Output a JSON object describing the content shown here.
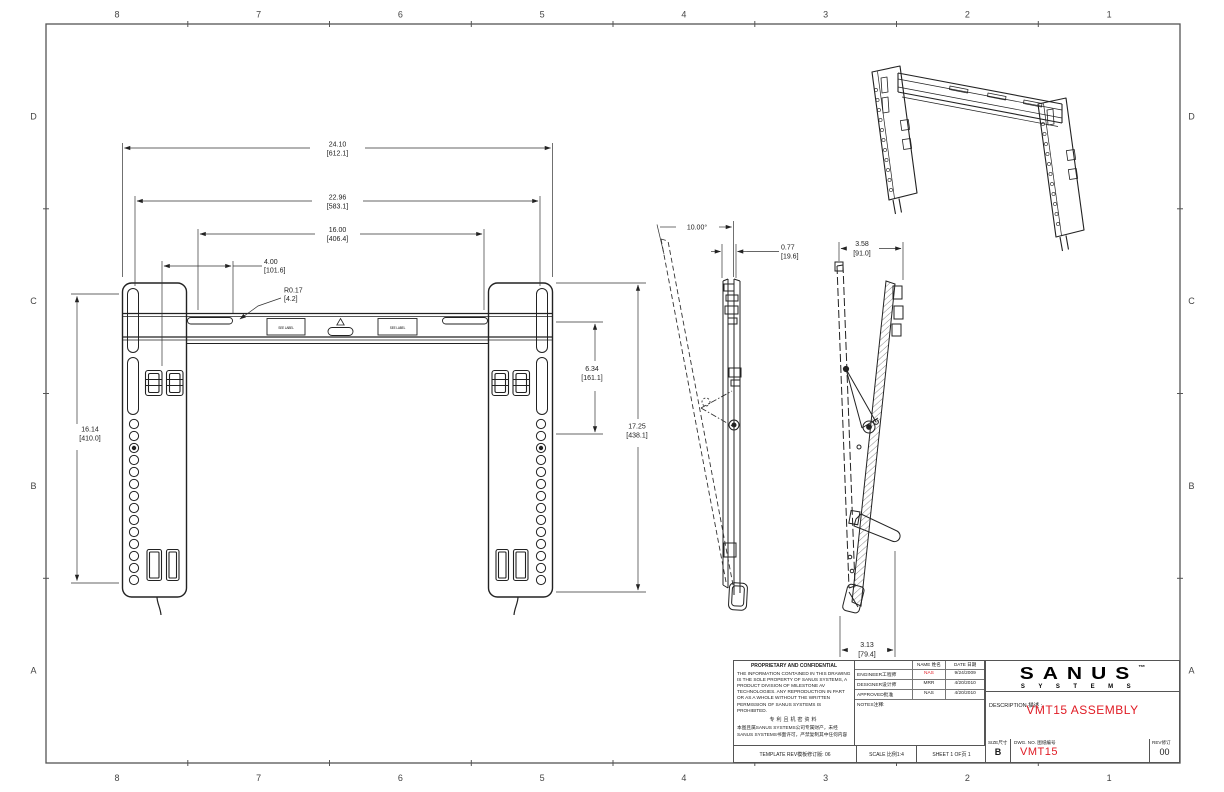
{
  "colors": {
    "accent_red": "#e01b24",
    "line_dark": "#222222",
    "border_gray": "#555555"
  },
  "drawing": {
    "zones": {
      "columns": [
        "8",
        "7",
        "6",
        "5",
        "4",
        "3",
        "2",
        "1"
      ],
      "rows": [
        "D",
        "C",
        "B",
        "A"
      ]
    },
    "views": {
      "front": {
        "dims": {
          "overall_width": {
            "in": "24.10",
            "mm": "[612.1]"
          },
          "slot_span": {
            "in": "22.96",
            "mm": "[583.1]"
          },
          "hole_span": {
            "in": "16.00",
            "mm": "[406.4]"
          },
          "offset": {
            "in": "4.00",
            "mm": "[101.6]"
          },
          "corner_radius": {
            "in": "R0.17",
            "mm": "[4.2]"
          },
          "bracket_hole_height": {
            "in": "16.14",
            "mm": "[410.0]"
          },
          "mid_height": {
            "in": "6.34",
            "mm": "[161.1]"
          },
          "overall_height": {
            "in": "17.25",
            "mm": "[438.1]"
          }
        },
        "rail_label": "SEE LABEL"
      },
      "side_tilt": {
        "angle": "10.00°",
        "depth": {
          "in": "0.77",
          "mm": "[19.6]"
        }
      },
      "side_open": {
        "top_depth": {
          "in": "3.58",
          "mm": "[91.0]"
        },
        "bottom_depth": {
          "in": "3.13",
          "mm": "[79.4]"
        }
      }
    }
  },
  "title_block": {
    "proprietary": {
      "heading": "PROPRIETARY AND CONFIDENTIAL",
      "body": "THE INFORMATION CONTAINED IN THIS DRAWING IS THE SOLE PROPERTY OF SANUS SYSTEMS, A PRODUCT DIVISION OF MILESTONE AV TECHNOLOGIES. ANY REPRODUCTION IN PART OR AS A WHOLE WITHOUT THE WRITTEN PERMISSION OF SANUS SYSTEMS IS PROHIBITED.",
      "heading_zh": "专利且机密资料",
      "body_zh": "本图且属SANUS SYSTEMS公司专属财产，未经SANUS SYSTEMS书面许可，严禁复制其中任何内容"
    },
    "approvals": {
      "name_header": "NAME 姓名",
      "date_header": "DATE 日期",
      "rows": [
        {
          "role": "ENGINEER工程师",
          "name": "NAS",
          "date": "9/24/2009"
        },
        {
          "role": "DESIGNER设计师",
          "name": "MRR",
          "date": "4/20/2010"
        },
        {
          "role": "APPROVED批准",
          "name": "NAS",
          "date": "4/20/2010"
        }
      ],
      "notes_label": "NOTES注释:"
    },
    "brand": {
      "logo": "SANUS",
      "tm": "™",
      "sub": "SYSTEMS"
    },
    "description_label": "DESCRIPTION 描述 :",
    "description_value": "VMT15 ASSEMBLY",
    "size_label": "SIZE尺寸",
    "size_value": "B",
    "dwg_label": "DWG. NO. 图纸编号",
    "dwg_value": "VMT15",
    "rev_label": "REV修订",
    "rev_value": "00",
    "template_rev": "TEMPLATE REV模板修订版: 06",
    "scale": "SCALE 比例1:4",
    "sheet": "SHEET 1 OF页 1"
  }
}
